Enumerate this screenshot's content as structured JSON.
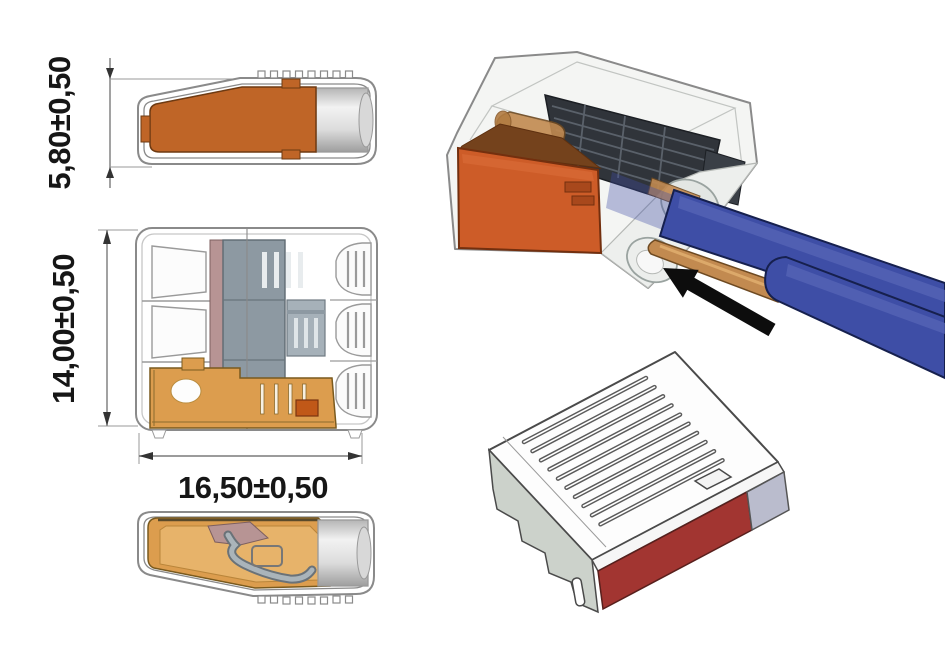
{
  "drawing": {
    "type": "technical-drawing-wire-connector",
    "dimensions": {
      "side_height_label": "5,80±0,50",
      "front_height_label": "14,00±0,50",
      "front_width_label": "16,50±0,50"
    },
    "views": {
      "side_top": "side view of push-wire connector with orange lever",
      "front": "front section view, 3-pole connector with clamp cage",
      "side_cutaway": "cutaway side view showing spring clamp",
      "insertion_3d": "3D view of transparent connector with two blue wires being inserted",
      "closed_3d": "3D view of closed connector housing with vent slots and red face"
    },
    "icons": {
      "insertion_arrow": "black arrow pointing up-left toward wire entry"
    }
  },
  "colors": {
    "housing_outline": "#8a8a8a",
    "lever_orange": "#bf6527",
    "lever_orange_3d": "#cd5c28",
    "cage_amber": "#dc9d4e",
    "test_slot_orange": "#c05818",
    "wire_blue": "#3e4ea6",
    "wire_copper": "#c28a50",
    "spring_dark": "#30343a",
    "front_red": "#a23531",
    "side_lavender": "#babccd",
    "side_gray_green": "#ccd2cb",
    "metal_gray": "#c9c9c9",
    "mauve": "#b79494",
    "slab_bluegray": "#8d99a2",
    "arrow_black": "#0d0d0d",
    "dim_text": "#161616"
  }
}
